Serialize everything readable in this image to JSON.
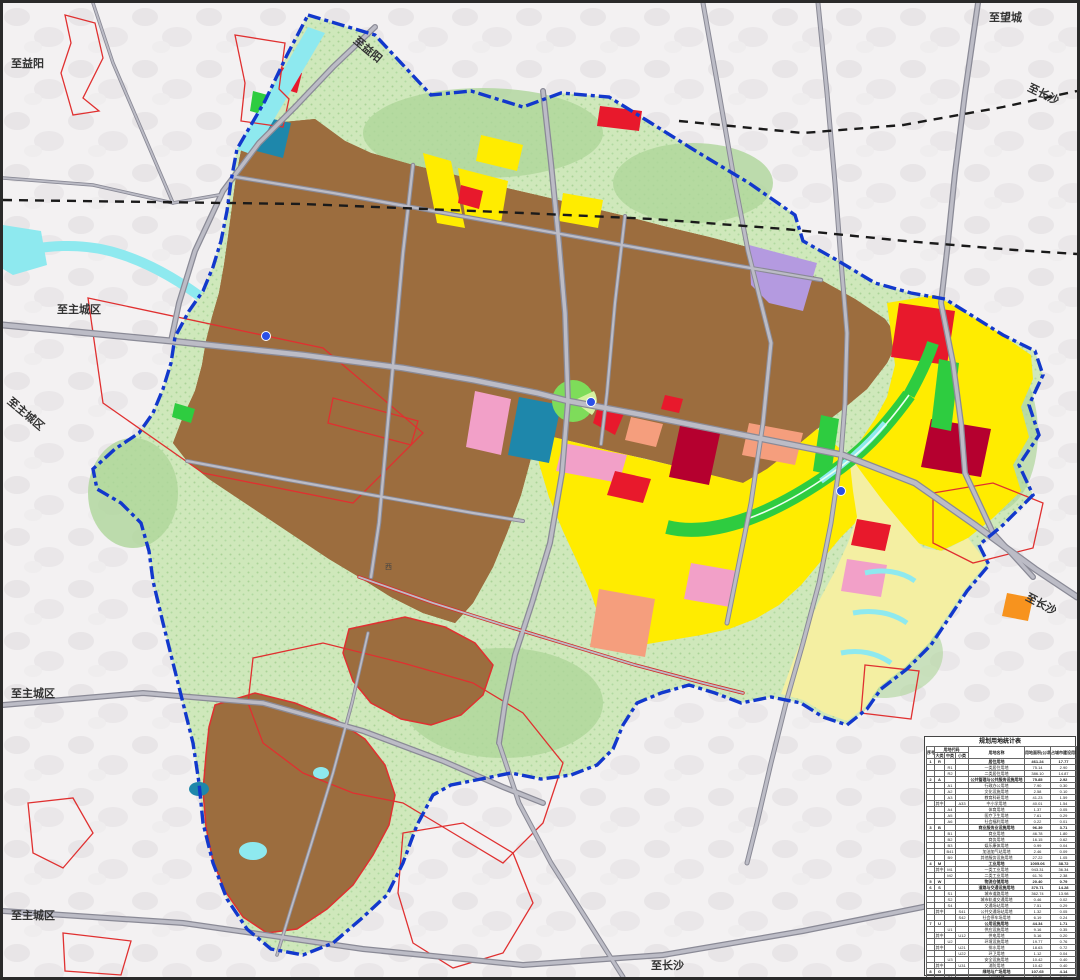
{
  "edge_labels": [
    {
      "id": "to-yiyang-left",
      "text": "至益阳"
    },
    {
      "id": "to-yiyang-top",
      "text": "至益阳"
    },
    {
      "id": "to-wangcheng-top",
      "text": "至望城"
    },
    {
      "id": "to-changsha-topright",
      "text": "至长沙"
    },
    {
      "id": "to-maincity-left1",
      "text": "至主城区"
    },
    {
      "id": "to-maincity-left2",
      "text": "至主城区"
    },
    {
      "id": "to-maincity-left3",
      "text": "至主城区"
    },
    {
      "id": "to-maincity-left4",
      "text": "至主城区"
    },
    {
      "id": "to-changsha-right",
      "text": "至长沙"
    },
    {
      "id": "to-changsha-bottom",
      "text": "至长沙"
    }
  ],
  "road_labels": [
    {
      "text": "西"
    }
  ],
  "colors": {
    "industrial_brown": "#9c6d3e",
    "residential_yellow": "#ffec00",
    "reserve_pale_yellow": "#f4efa2",
    "commercial_red": "#e8192c",
    "dark_red": "#b5002f",
    "pink": "#f2a0c8",
    "salmon": "#f59e7d",
    "logistics_purple": "#b49ae0",
    "education_teal": "#1e87ab",
    "park_bright_green": "#2ecc40",
    "eco_green": "#cfe8bb",
    "water_cyan": "#8ee9ef",
    "orange": "#f7931e",
    "road_gray": "#bcbcc6",
    "boundary_blue": "#1238cc",
    "village_outline_red": "#e03030",
    "railway_black": "#1a1a1a"
  },
  "table": {
    "title": "规划用地统计表",
    "h_seq": "序号",
    "h_code": "用地代码",
    "h_major": "大类",
    "h_mid": "中类",
    "h_minor": "小类",
    "h_name": "用地名称",
    "h_area": "用地面积(公顷)",
    "h_pct": "占城市建设用地比例(%)",
    "rows": [
      [
        "1",
        "R",
        "",
        "",
        "居住用地",
        "461.24",
        "17.77",
        1
      ],
      [
        "",
        "",
        "R1",
        "",
        "一类居住用地",
        "75.14",
        "2.90",
        0
      ],
      [
        "",
        "",
        "R2",
        "",
        "二类居住用地",
        "386.10",
        "14.87",
        0
      ],
      [
        "2",
        "A",
        "",
        "",
        "公共管理与公共服务设施用地",
        "75.85",
        "2.92",
        1
      ],
      [
        "",
        "",
        "A1",
        "",
        "行政办公用地",
        "7.90",
        "0.30",
        0
      ],
      [
        "",
        "",
        "A2",
        "",
        "文化设施用地",
        "2.58",
        "0.10",
        0
      ],
      [
        "",
        "",
        "A3",
        "",
        "教育科研用地",
        "41.23",
        "1.59",
        0
      ],
      [
        "",
        "其中",
        "",
        "A33",
        "中小学用地",
        "40.01",
        "1.54",
        0
      ],
      [
        "",
        "",
        "A4",
        "",
        "体育用地",
        "1.37",
        "0.05",
        0
      ],
      [
        "",
        "",
        "A5",
        "",
        "医疗卫生用地",
        "7.61",
        "0.29",
        0
      ],
      [
        "",
        "",
        "A6",
        "",
        "社会福利用地",
        "0.22",
        "0.01",
        0
      ],
      [
        "3",
        "B",
        "",
        "",
        "商业服务业设施用地",
        "96.39",
        "3.71",
        1
      ],
      [
        "",
        "",
        "B1",
        "",
        "商业用地",
        "46.78",
        "1.80",
        0
      ],
      [
        "",
        "",
        "B2",
        "",
        "商务用地",
        "16.15",
        "0.62",
        0
      ],
      [
        "",
        "",
        "B3",
        "",
        "娱乐康体用地",
        "0.99",
        "0.04",
        0
      ],
      [
        "",
        "",
        "B41",
        "",
        "加油加气站用地",
        "2.46",
        "0.09",
        0
      ],
      [
        "",
        "",
        "B9",
        "",
        "其他服务设施用地",
        "27.22",
        "1.05",
        0
      ],
      [
        "4",
        "M",
        "",
        "",
        "工业用地",
        "1005.06",
        "38.72",
        1
      ],
      [
        "",
        "其中",
        "M1",
        "",
        "一类工业用地",
        "943.31",
        "36.34",
        0
      ],
      [
        "",
        "",
        "M2",
        "",
        "二类工业用地",
        "61.76",
        "2.38",
        0
      ],
      [
        "5",
        "W",
        "",
        "",
        "物流仓储用地",
        "20.40",
        "0.79",
        1
      ],
      [
        "6",
        "S",
        "",
        "",
        "道路与交通设施用地",
        "370.71",
        "14.28",
        1
      ],
      [
        "",
        "",
        "S1",
        "",
        "城市道路用地",
        "362.74",
        "13.98",
        0
      ],
      [
        "",
        "",
        "S2",
        "",
        "城市轨道交通用地",
        "0.46",
        "0.02",
        0
      ],
      [
        "",
        "",
        "S4",
        "",
        "交通场站用地",
        "7.51",
        "0.29",
        0
      ],
      [
        "",
        "其中",
        "",
        "S41",
        "公共交通场站用地",
        "1.32",
        "0.05",
        0
      ],
      [
        "",
        "",
        "",
        "S42",
        "社会停车场用地",
        "6.19",
        "0.24",
        0
      ],
      [
        "7",
        "U",
        "",
        "",
        "公用设施用地",
        "44.34",
        "1.71",
        1
      ],
      [
        "",
        "",
        "U1",
        "",
        "供应设施用地",
        "9.16",
        "0.35",
        0
      ],
      [
        "",
        "其中",
        "",
        "U12",
        "供电用地",
        "5.16",
        "0.20",
        0
      ],
      [
        "",
        "",
        "U2",
        "",
        "环境设施用地",
        "19.77",
        "0.76",
        0
      ],
      [
        "",
        "其中",
        "",
        "U21",
        "排水用地",
        "18.63",
        "0.72",
        0
      ],
      [
        "",
        "",
        "",
        "U22",
        "环卫用地",
        "1.12",
        "0.04",
        0
      ],
      [
        "",
        "",
        "U3",
        "",
        "安全设施用地",
        "10.42",
        "0.40",
        0
      ],
      [
        "",
        "其中",
        "",
        "U31",
        "消防用地",
        "10.42",
        "0.40",
        0
      ],
      [
        "8",
        "G",
        "",
        "",
        "绿地与广场用地",
        "107.65",
        "4.14",
        1
      ],
      [
        "",
        "",
        "G1",
        "",
        "公园绿地",
        "67.75",
        "2.61",
        0
      ],
      [
        "",
        "",
        "G2",
        "",
        "防护绿地",
        "39.01",
        "1.50",
        0
      ],
      [
        "",
        "",
        "G3",
        "",
        "广场用地",
        "0.89",
        "0.03",
        0
      ],
      [
        "9",
        "合计",
        "",
        "",
        "城市建设用地",
        "2595.72",
        "100.00",
        1
      ]
    ]
  }
}
